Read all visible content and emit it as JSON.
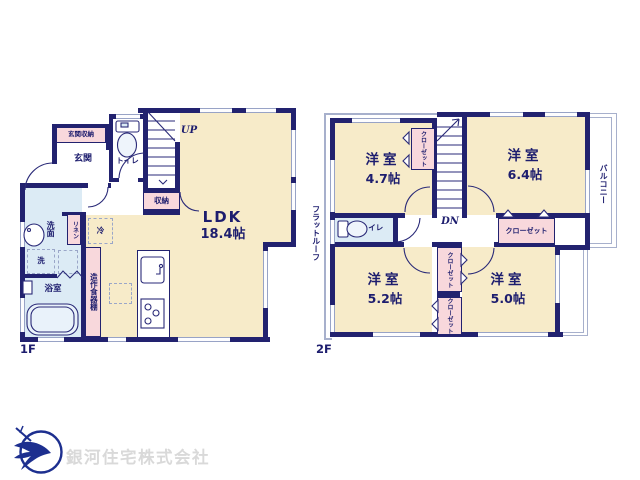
{
  "floor1": {
    "label": "1F",
    "up": "UP",
    "entrance_storage": "玄関収納",
    "entrance": "玄関",
    "toilet": "トイレ",
    "storage": "収納",
    "ldk": {
      "name": "LDK",
      "size": "18.4帖"
    },
    "washroom": "洗面",
    "linen": "リネン",
    "fridge": "冷",
    "laundry": "洗",
    "bathroom": "浴室",
    "cupboard": "造作食器棚"
  },
  "floor2": {
    "label": "2F",
    "dn": "DN",
    "flat_roof": "フラットルーフ",
    "balcony": "バルコニー",
    "toilet": "トイレ",
    "rooms": [
      {
        "name": "洋室",
        "size": "4.7帖"
      },
      {
        "name": "洋室",
        "size": "6.4帖"
      },
      {
        "name": "洋室",
        "size": "5.2帖"
      },
      {
        "name": "洋室",
        "size": "5.0帖"
      }
    ],
    "closets": {
      "room1": "クローゼット",
      "room2": "クローゼット",
      "mid_upper": "クローゼット",
      "mid_lower": "クローゼット"
    }
  },
  "footer": {
    "company": "銀河住宅株式会社"
  },
  "colors": {
    "wall": "#22226f",
    "floor_cream": "#f7ebc9",
    "floor_blue": "#dcebf5",
    "accent_pink": "#f8d8dc",
    "roof_outline": "#a7b0cc",
    "company_text": "#d9d9d9",
    "logo_navy": "#1d2f8f"
  }
}
